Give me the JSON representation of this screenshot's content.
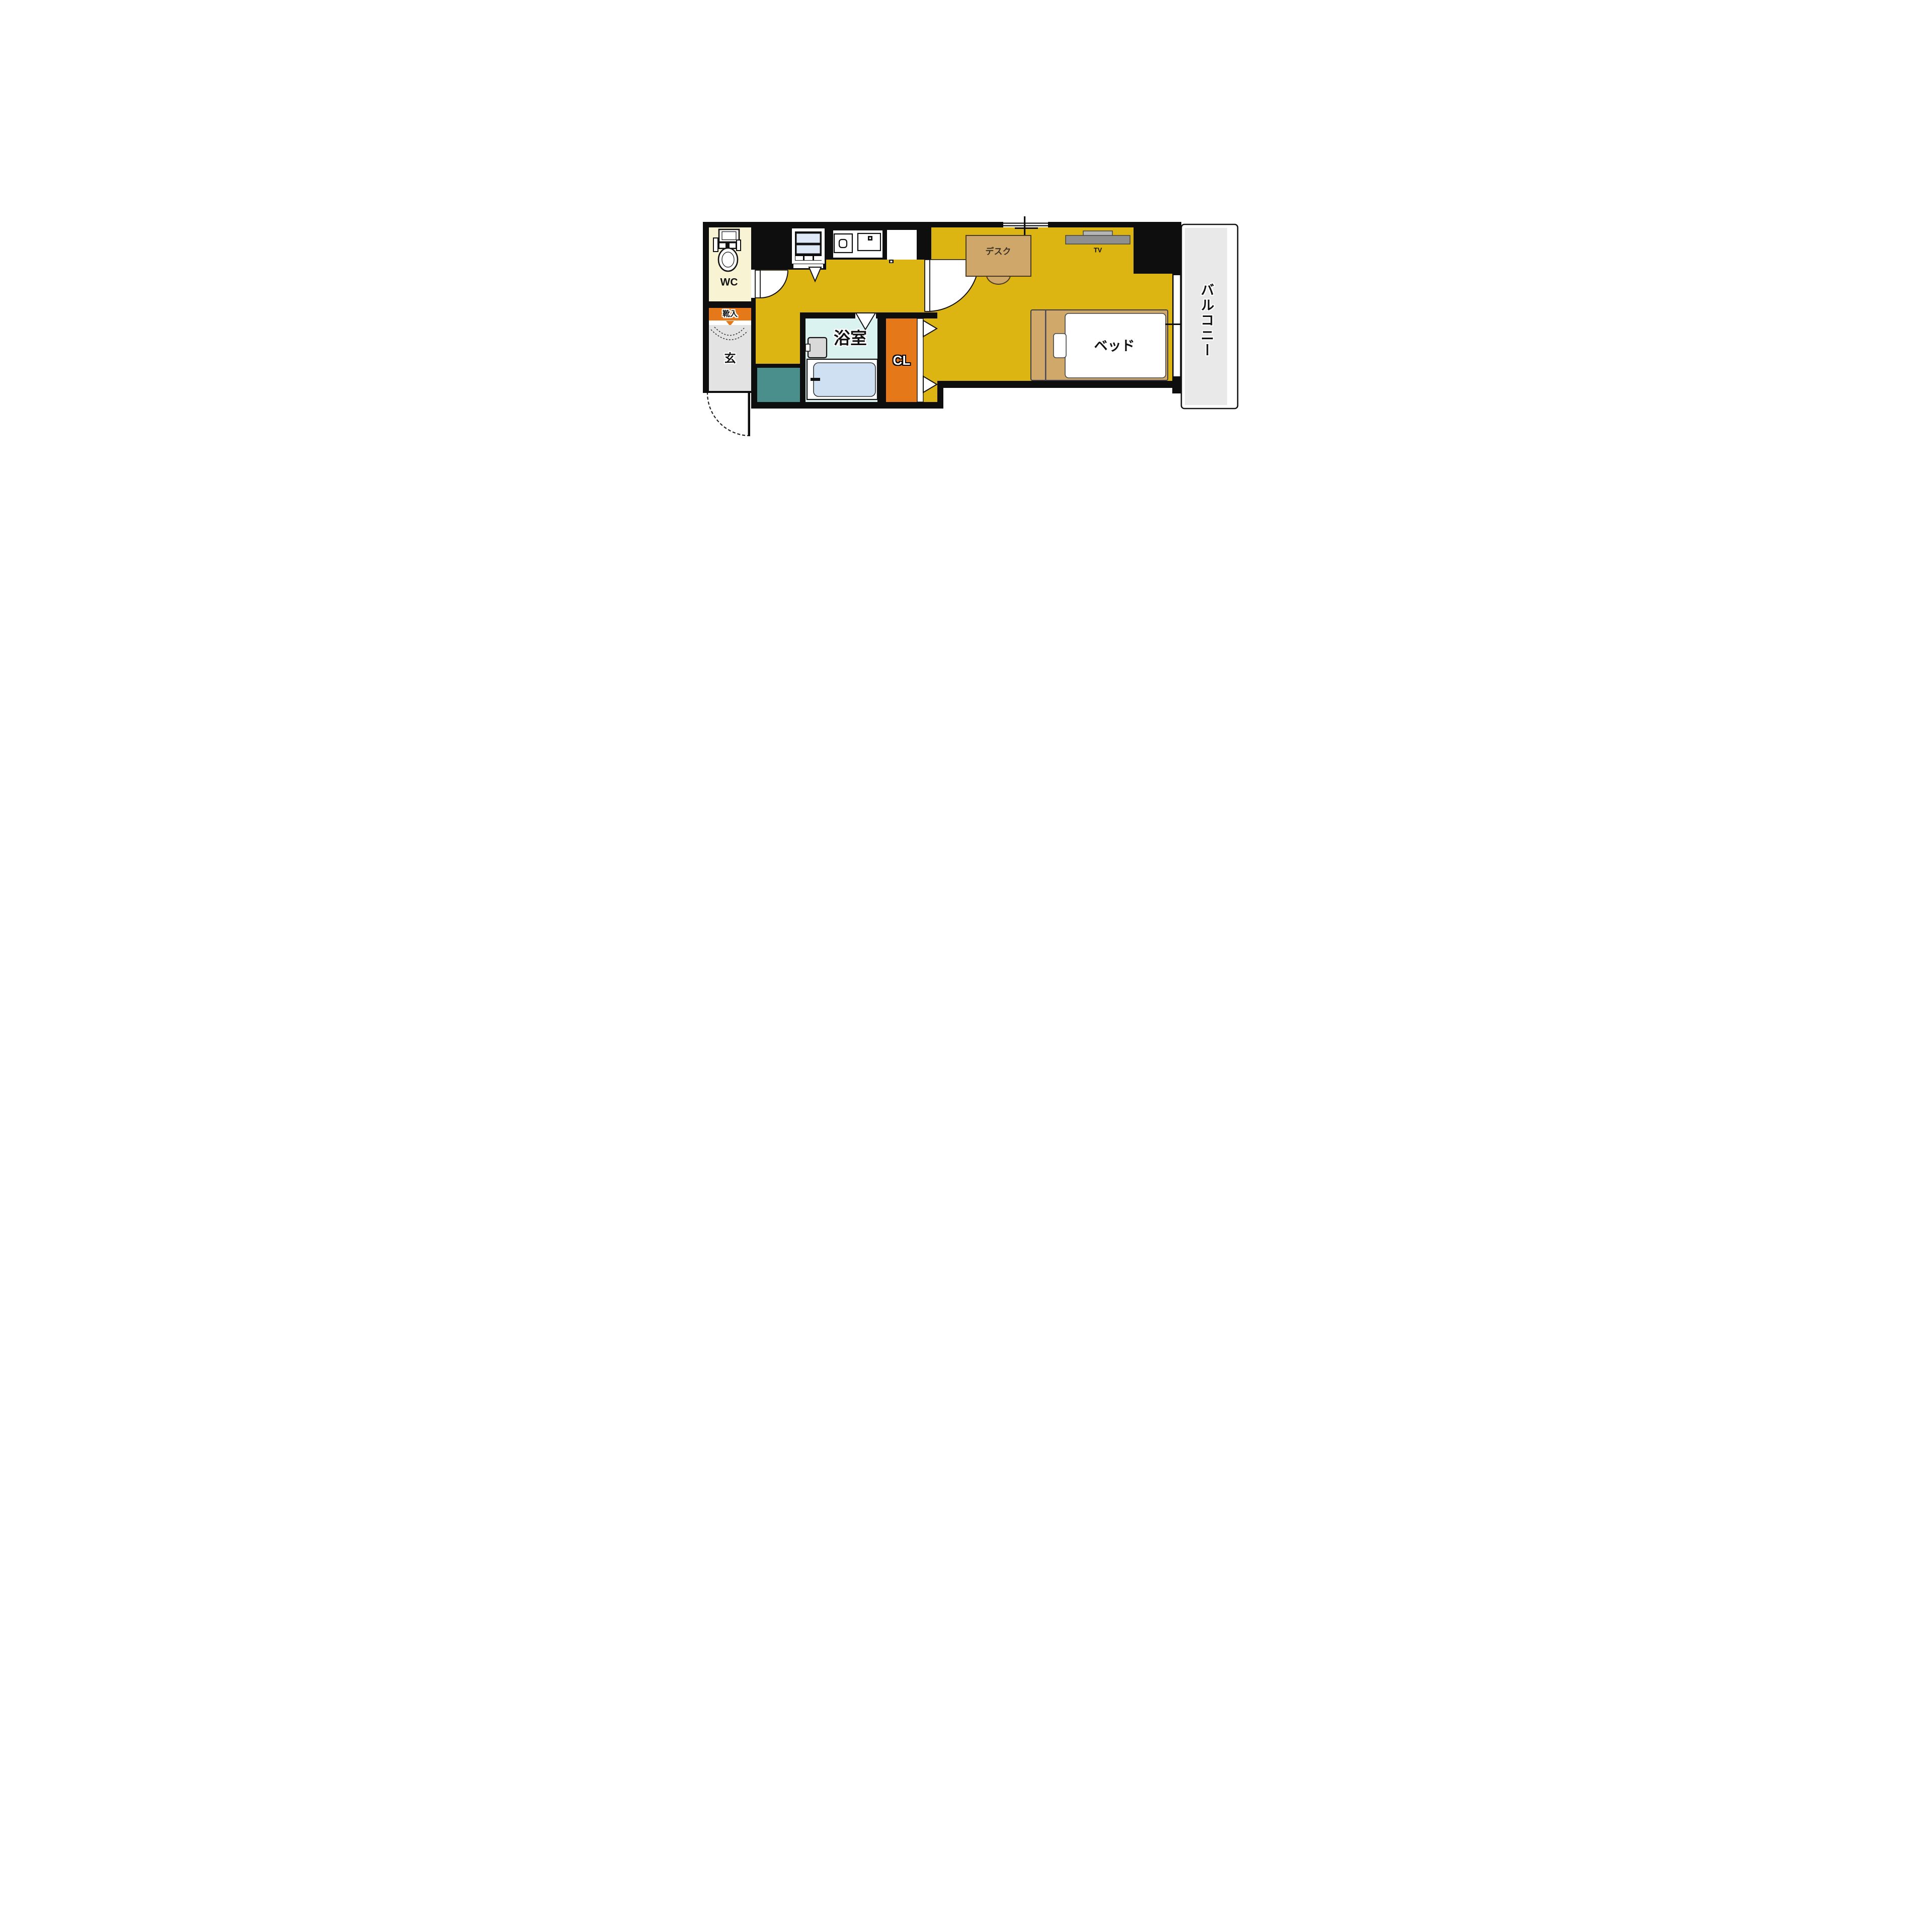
{
  "floorplan": {
    "type": "apartment-room-layout",
    "rooms": {
      "wc": {
        "label": "WC"
      },
      "shoe_cabinet": {
        "label": "靴入"
      },
      "entrance": {
        "label": "玄"
      },
      "bathroom": {
        "label": "浴室"
      },
      "closet": {
        "label": "CL"
      },
      "balcony": {
        "label": "バルコニー"
      }
    },
    "furniture": {
      "desk": {
        "label": "デスク"
      },
      "tv": {
        "label": "TV"
      },
      "bed": {
        "label": "ベッド"
      }
    },
    "colors": {
      "floor_yellow": "#dcb512",
      "wall_black": "#0e0e0e",
      "wc_cream": "#f7f3d3",
      "orange": "#e5791a",
      "bathroom_cyan": "#daf2f0",
      "bathtub_blue": "#cfe0f2",
      "entrance_gray": "#e3e3e3",
      "balcony_gray": "#e9e9e9",
      "washer_space_teal": "#4a8f8c",
      "furniture_tan": "#cfa76b",
      "tv_gray": "#8f8f8f"
    }
  }
}
